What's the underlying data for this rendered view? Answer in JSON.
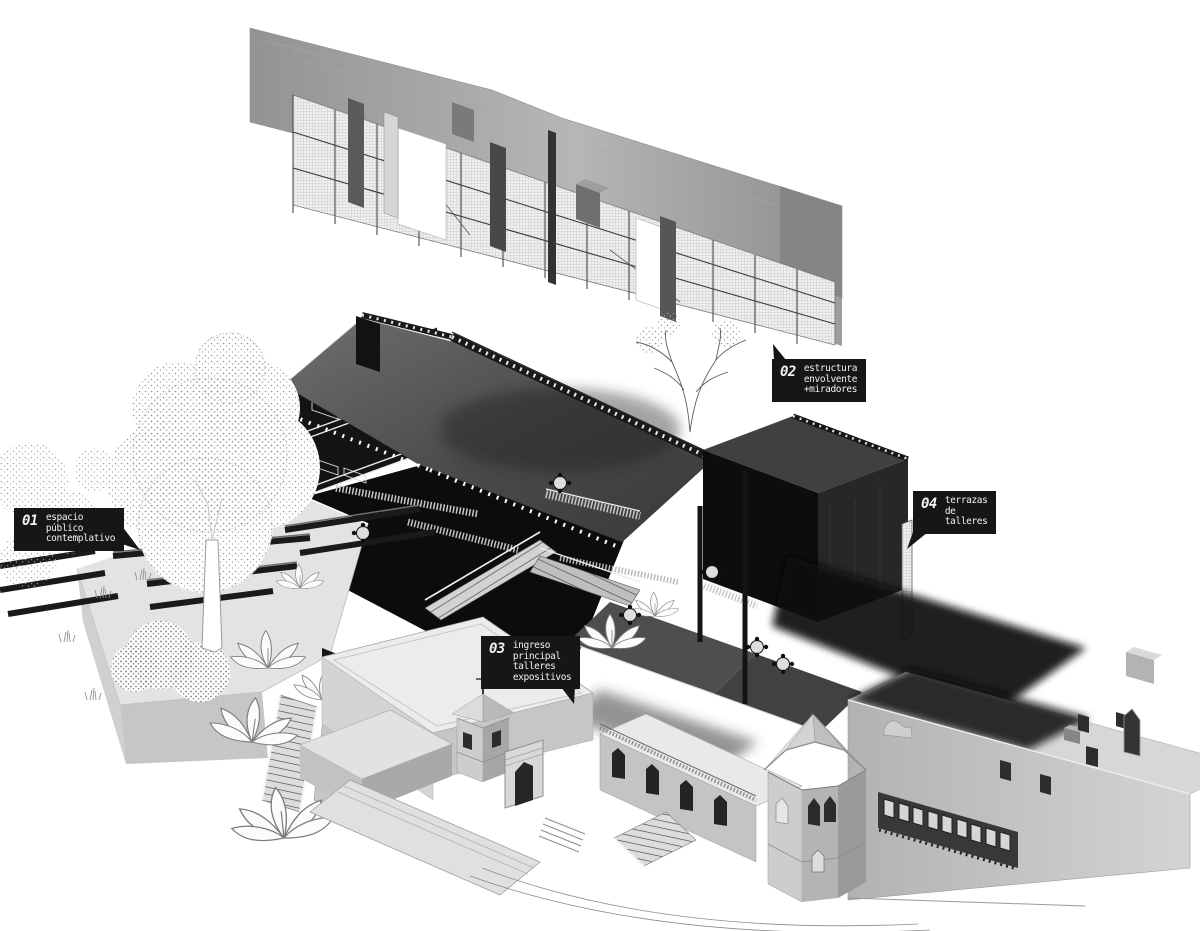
{
  "figure": {
    "kind": "exploded axonometric architecture diagram",
    "background": "#ffffff",
    "callout_bg": "#161616",
    "callout_text": "#f2f2f2",
    "drawing_grays": [
      "#0c0c0c",
      "#3f3f3f",
      "#8a8a8a",
      "#c9c9c9",
      "#ececec"
    ]
  },
  "callouts": [
    {
      "number": "01",
      "lines": [
        "espacio",
        "público",
        "contemplativo"
      ]
    },
    {
      "number": "02",
      "lines": [
        "estructura",
        "envolvente",
        "+miradores"
      ]
    },
    {
      "number": "03",
      "lines": [
        "ingreso",
        "principal",
        "talleres",
        "expositivos"
      ]
    },
    {
      "number": "04",
      "lines": [
        "terrazas",
        "de",
        "talleres"
      ]
    }
  ]
}
